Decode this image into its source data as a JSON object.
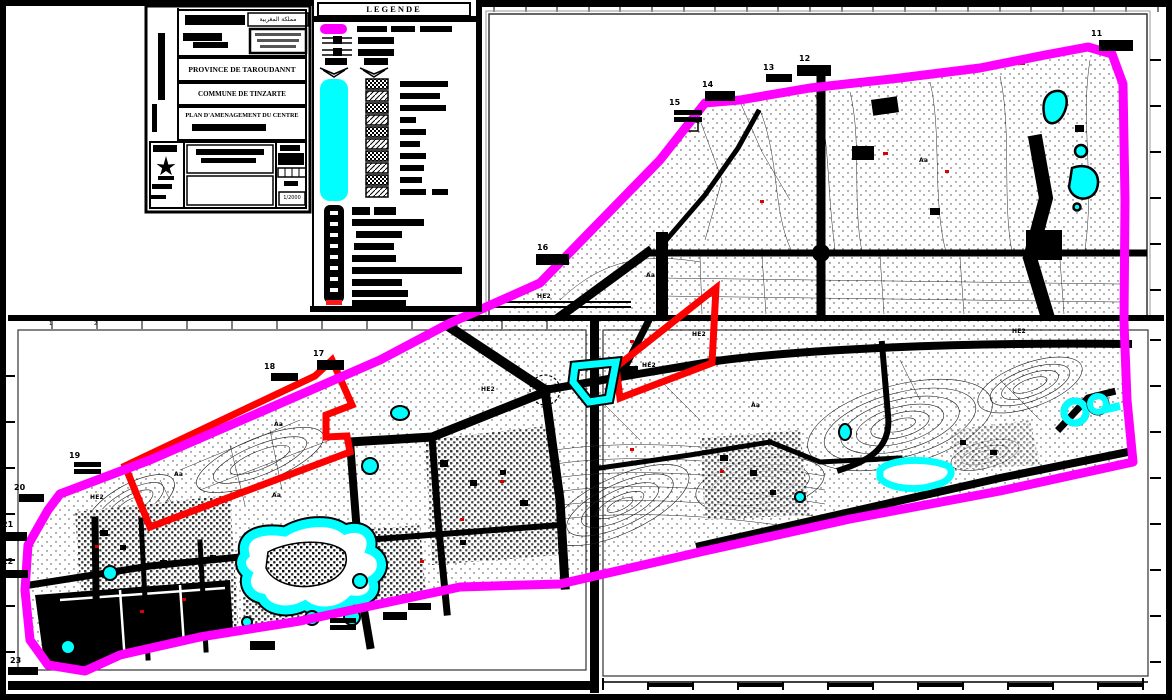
{
  "title_block": {
    "kingdom_ar": "مملكة المغربية",
    "province": "PROVINCE DE TAROUDANNT",
    "commune": "COMMUNE DE TINZARTE",
    "plan_title": "PLAN D'AMENAGEMENT DU CENTRE",
    "scale": "1/2000"
  },
  "legend": {
    "title": "LEGENDE",
    "symbols": [
      "plan-boundary-pill",
      "road-symbol",
      "road-symbol",
      "chevron-marker",
      "chevron-marker",
      "water-bar",
      "zone-hatch-boxes",
      "sector-black-bar",
      "sector-red-marker"
    ]
  },
  "map": {
    "boundary_points": [
      {
        "label": "11"
      },
      {
        "label": "12"
      },
      {
        "label": "13"
      },
      {
        "label": "14"
      },
      {
        "label": "15"
      },
      {
        "label": "16"
      },
      {
        "label": "17"
      },
      {
        "label": "18"
      },
      {
        "label": "19"
      },
      {
        "label": "20"
      },
      {
        "label": "21"
      },
      {
        "label": "22"
      },
      {
        "label": "23"
      }
    ],
    "zone_labels": [
      {
        "text": "HE2"
      },
      {
        "text": "HE2"
      },
      {
        "text": "HE2"
      },
      {
        "text": "HE2"
      },
      {
        "text": "HE2"
      },
      {
        "text": "HE2"
      },
      {
        "text": "Aa"
      },
      {
        "text": "Aa"
      },
      {
        "text": "Aa"
      },
      {
        "text": "Aa"
      },
      {
        "text": "Aa"
      },
      {
        "text": "Aa"
      }
    ],
    "ruler_labels": [
      "1",
      "2"
    ],
    "colors": {
      "boundary": "#FF00FF",
      "water": "#00FFFF",
      "zone_outline": "#FF0000",
      "ink": "#000000"
    }
  }
}
